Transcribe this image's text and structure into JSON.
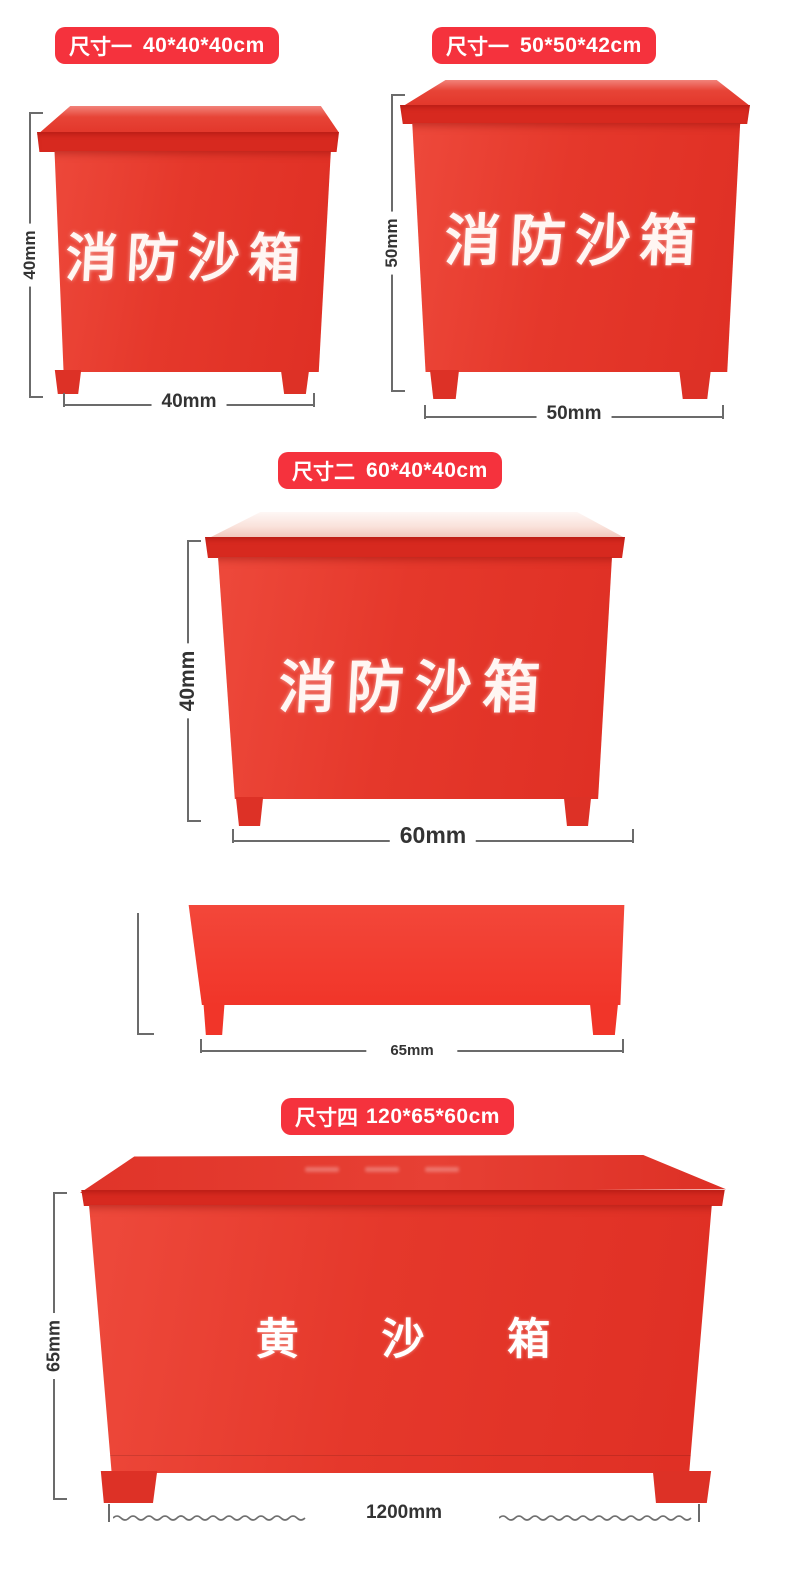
{
  "colors": {
    "badge_red": "#f5323d",
    "box_red": "#e5382b",
    "lid_red": "#d7291f",
    "dimension_line_gray": "#6b6b6b",
    "dimension_text": "#333333",
    "box_text_white": "#fff6f3"
  },
  "badges": {
    "b1": {
      "label": "尺寸一",
      "size": "40*40*40cm"
    },
    "b2": {
      "label": "尺寸一",
      "size": "50*50*42cm"
    },
    "b3": {
      "label": "尺寸二",
      "size": "60*40*40cm"
    },
    "b4": {
      "label": "尺寸四",
      "size": "120*65*60cm"
    }
  },
  "boxes": {
    "box1": {
      "front_text": "消防沙箱",
      "height_dim": "40mm",
      "width_dim": "40mm"
    },
    "box2": {
      "front_text": "消防沙箱",
      "height_dim": "50mm",
      "width_dim": "50mm"
    },
    "box3": {
      "front_text": "消防沙箱",
      "height_dim": "40mm",
      "width_dim": "60mm"
    },
    "box4": {
      "width_dim": "65mm"
    },
    "box5": {
      "front_text": "黄 沙 箱",
      "height_dim": "65mm",
      "width_dim": "1200mm"
    }
  }
}
